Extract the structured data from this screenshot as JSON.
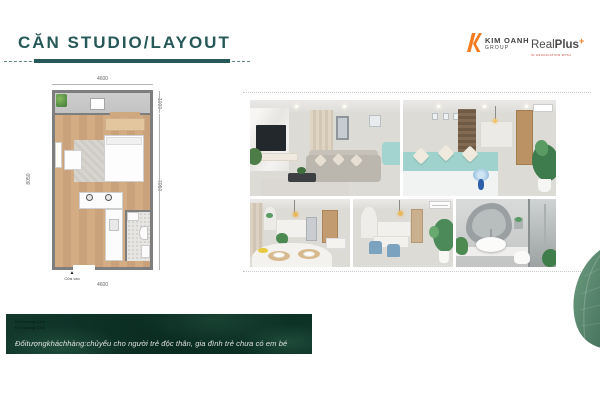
{
  "slide": {
    "title": "CĂN STUDIO/LAYOUT"
  },
  "logos": {
    "kim_oanh": {
      "name": "KIM OANH",
      "sub": "GROUP"
    },
    "realplus": {
      "real": "Real",
      "plus": "Plus",
      "mark": "+",
      "tagline": "IN ASSOCIATION WITH"
    }
  },
  "floorplan": {
    "dim_top": "4600",
    "dim_bottom": "4600",
    "dim_left": "8050",
    "dim_right_upper": "1000",
    "dim_right_lower": "7050",
    "entrance_marker": "▲",
    "entrance_label": "Cửa vào"
  },
  "photos": [
    {
      "id": "living-room",
      "label": "living room with marble tv wall, sofa and coffee table"
    },
    {
      "id": "bedroom-kitchen",
      "label": "bedroom with teal bedding, kitchen and dining behind"
    },
    {
      "id": "kitchen-dining",
      "label": "kitchen with dining table, placemats and pendant light"
    },
    {
      "id": "dining-area",
      "label": "dining area with blue chairs, plant and air conditioner"
    },
    {
      "id": "bathroom",
      "label": "bathroom with organic mirror, round sink and glass shower"
    }
  ],
  "banner": {
    "micro_line_1": "Đối tượng Chủ",
    "micro_line_2": "Đối tượng Chủ",
    "text": "Đốitượngkháchhàng:chủyếu cho người trẻ độc thân, gia đình trẻ chưa có em bé"
  },
  "colors": {
    "accent": "#265858",
    "banner_green": "#0d3428",
    "logo_orange": "#f47b20",
    "leaf_green": "#5b8a70",
    "wood_floor": "#cfa87f"
  }
}
